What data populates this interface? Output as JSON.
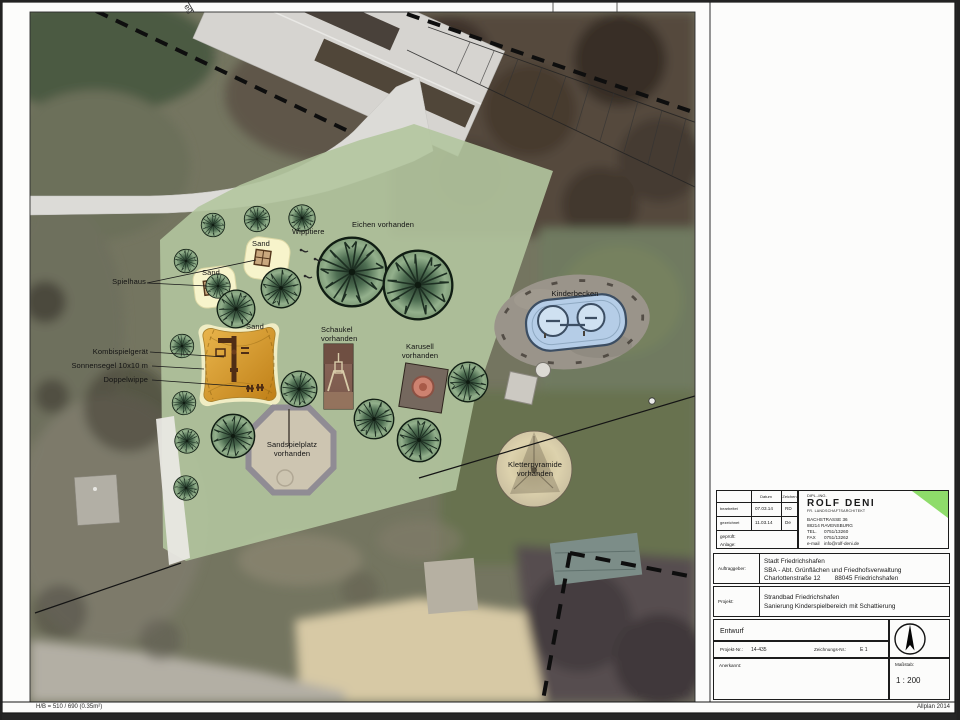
{
  "plan_labels": {
    "spielhaus": "Spielhaus",
    "sand": "Sand",
    "wipptiere": "Wipptiere",
    "eichen": "Eichen vorhanden",
    "kombispielgeraet": "Kombispielgerät",
    "sonnensegel": "Sonnensegel 10x10 m",
    "doppelwippe": "Doppelwippe",
    "schaukel": "Schaukel\nvorhanden",
    "karussell": "Karusell\nvorhanden",
    "kinderbecken": "Kinderbecken",
    "sandspielplatz": "Sandspielplatz\nvorhanden",
    "kletterpyramide": "Kletterpyramide\nvorhanden",
    "street_fragment": "eg"
  },
  "title_block": {
    "meta": {
      "col_datum": "Datum",
      "col_zeichen": "Zeichen",
      "rows": [
        {
          "label": "bearbeitet",
          "datum": "07.03.14",
          "zeichen": "RD"
        },
        {
          "label": "gezeichnet",
          "datum": "11.03.14",
          "zeichen": "De"
        }
      ],
      "geprueft": "geprüft:",
      "anlage": "Anlage:"
    },
    "architect": {
      "title": "DIPL.-ING.",
      "name": "ROLF DENI",
      "subtitle": "FR. LANDSCHAFTSARCHITEKT",
      "address1": "BACHSTRASSE 36",
      "address2": "88214 RAVENSBURG",
      "tel_label": "TEL.",
      "tel": "0751/13260",
      "fax_label": "FAX",
      "fax": "0751/13262",
      "email_label": "e-mail",
      "email": "info@rolf-deni.de"
    },
    "auftraggeber_label": "Auftraggeber:",
    "auftraggeber": "Stadt Friedrichshafen\nSBA - Abt. Grünflächen und Friedhofsverwaltung\nCharlottenstraße 12        88045 Friedrichshafen",
    "projekt_label": "Projekt:",
    "projekt": "Strandbad Friedrichshafen\nSanierung Kinderspielbereich mit Schattierung",
    "phase": "Entwurf",
    "projekt_nr_label": "Projekt-Nr.:",
    "projekt_nr": "14-435",
    "zeichnungs_nr_label": "Zeichnungs-Nr.:",
    "zeichnungs_nr": "E 1",
    "anerkannt_label": "Anerkannt:",
    "massstab_label": "Maßstab:",
    "massstab": "1 : 200",
    "accent_green": "#8edc6a"
  },
  "footer": {
    "left": "H/B = 510 / 690 (0.35m²)",
    "right": "Allplan 2014"
  }
}
